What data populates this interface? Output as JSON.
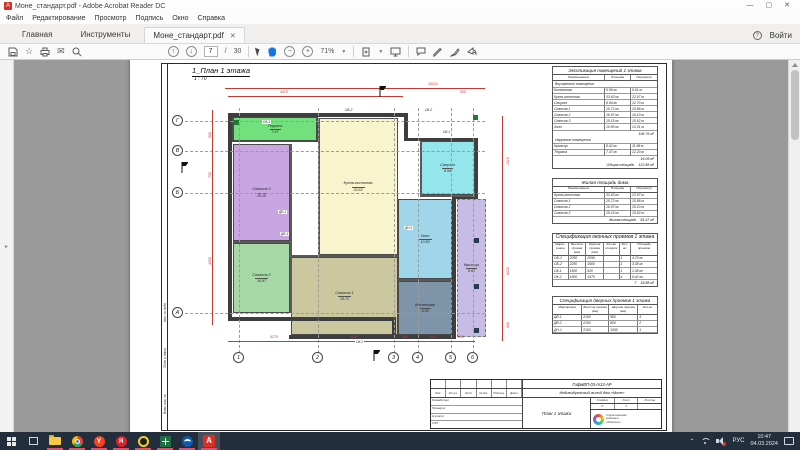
{
  "window": {
    "title": "Моне_стандарт.pdf - Adobe Acrobat Reader DC",
    "controls": {
      "minimize": "—",
      "maximize": "▢",
      "close": "✕"
    }
  },
  "menu": {
    "items": [
      "Файл",
      "Редактирование",
      "Просмотр",
      "Подпись",
      "Окно",
      "Справка"
    ]
  },
  "tabs": {
    "home": "Главная",
    "tools": "Инструменты",
    "document": "Моне_стандарт.pdf",
    "close": "✕",
    "help": "?",
    "sign_in": "Войти"
  },
  "toolbar": {
    "page_current": "7",
    "page_divider": "/",
    "page_total": "30",
    "zoom_level": "71%"
  },
  "colors": {
    "dimension_red": "#c23a32",
    "underline_pink": "#d9536f",
    "acrobat_red": "#d93025"
  },
  "drawing": {
    "title": "1_План 1 этажа",
    "scale": "1 : 70",
    "axes_letters": [
      "Г",
      "В",
      "Б",
      "А"
    ],
    "axes_numbers": [
      "1",
      "2",
      "3",
      "4",
      "5",
      "6"
    ],
    "rooms": [
      {
        "name": "Терраса",
        "area": "7.47",
        "color": "#72e07c"
      },
      {
        "name": "Кухня-гостиная",
        "area": "33.63",
        "color": "#f8f4cd"
      },
      {
        "name": "Спальня 3",
        "area": "15.15",
        "color": "#c9a6e2"
      },
      {
        "name": "Спальня 2",
        "area": "16.97",
        "color": "#a6d9a6"
      },
      {
        "name": "Спальня 1",
        "area": "15.72",
        "color": "#cbc8a0"
      },
      {
        "name": "Санузел",
        "area": "8.94",
        "color": "#93e7ec"
      },
      {
        "name": "Холл",
        "area": "10.80",
        "color": "#9fd6e9"
      },
      {
        "name": "Котельная",
        "area": "5.55",
        "color": "#7e95a9"
      },
      {
        "name": "Крыльцо",
        "area": "8.62",
        "color": "#c6bce6"
      }
    ],
    "openings": {
      "ob1": "ОБ-1",
      "ob2": "ОБ-2",
      "ok1": "ОК-1",
      "ok2": "ОК-2",
      "dv1": "ДВ-1",
      "dn1": "ДН-1"
    },
    "dims": {
      "top_overall": "16210",
      "top_left": "4470",
      "top_right": "900",
      "bottom_1": "4270",
      "bottom_2": "4250",
      "bottom_3": "800",
      "bottom_4": "1600",
      "bottom_5": "800",
      "left_1": "500",
      "left_2": "750",
      "left_3": "4650",
      "right_1": "1810",
      "right_2": "6020",
      "right_3": "880"
    }
  },
  "tables": {
    "explication": {
      "title": "Экспликация помещений 1 этажа",
      "cols": [
        "Наименование",
        "Площадь",
        "Периметр"
      ],
      "section1": "Внутренние помещения",
      "rows1": [
        [
          "Котельная",
          "5.55 м²",
          "9.61 м"
        ],
        [
          "Кухня-гостиная",
          "33.63 м²",
          "23.97 м"
        ],
        [
          "Санузел",
          "8.94 м²",
          "12.70 м"
        ],
        [
          "Спальня 1",
          "15.72 м²",
          "15.86 м"
        ],
        [
          "Спальня 2",
          "16.97 м²",
          "16.10 м"
        ],
        [
          "Спальня 3",
          "15.15 м²",
          "15.62 м"
        ],
        [
          "Холл",
          "10.80 м²",
          "13.01 м"
        ]
      ],
      "subtotal1": "106.76 м²",
      "section2": "Наружные помещения",
      "rows2": [
        [
          "Крыльцо",
          "8.62 м²",
          "11.98 м"
        ],
        [
          "Терраса",
          "7.47 м²",
          "12.20 м"
        ]
      ],
      "subtotal2": "16.09 м²",
      "total_label": "Общая площадь",
      "total": "122.85 м²"
    },
    "living": {
      "title": "Жилая площадь дома",
      "cols": [
        "Наименование",
        "Площадь",
        "Периметр"
      ],
      "rows": [
        [
          "Кухня-гостиная",
          "33.63 м²",
          "23.97 м"
        ],
        [
          "Спальня 1",
          "15.72 м²",
          "15.86 м"
        ],
        [
          "Спальня 2",
          "16.97 м²",
          "16.10 м"
        ],
        [
          "Спальня 3",
          "15.15 м²",
          "15.62 м"
        ]
      ],
      "total_label": "Жилая площадь",
      "total": "81.47 м²"
    },
    "windows": {
      "title": "Спецификация оконных проемов 1 этажа",
      "cols": [
        "Марки- ровка",
        "Высота проема (мм)",
        "Ширина проема (мм)",
        "Кол-во створок",
        "Кол- во",
        "Площадь проемов"
      ],
      "rows": [
        [
          "ОБ-1",
          "2250",
          "2090",
          "",
          "1",
          "4.70 м²"
        ],
        [
          "ОБ-2",
          "2250",
          "1500",
          "",
          "1",
          "3.38 м²"
        ],
        [
          "ОК-1",
          "1500",
          "920",
          "",
          "1",
          "1.38 м²"
        ],
        [
          "ОК-2",
          "1500",
          "1570",
          "",
          "4",
          "9.42 м²"
        ]
      ],
      "total_count": "7",
      "total_area": "18.88 м²"
    },
    "doors": {
      "title": "Спецификация дверных проемов 1 этажа",
      "cols": [
        "Маркировка",
        "Высота проема (мм)",
        "Ширина проема (мм)",
        "Кол-во"
      ],
      "rows": [
        [
          "ДВ-1",
          "2100",
          "900",
          "3"
        ],
        [
          "ДВ-2",
          "2100",
          "800",
          "2"
        ],
        [
          "ДН-1",
          "2100",
          "1050",
          "1"
        ]
      ]
    }
  },
  "title_block": {
    "code": "ГифмВП-03-т13-АР",
    "object": "Индивидуальный жилой дом «Моне»",
    "sheet_title": "План 1 этажа",
    "stamp_cols": [
      "Изм.",
      "Кол.уч.",
      "Лист",
      "№ док.",
      "Подпись",
      "Дата"
    ],
    "roles": [
      "Разработал",
      "Проверил",
      "Н.контр.",
      "ГИП"
    ],
    "stage_label": "Стадия",
    "sheet_label": "Лист",
    "sheets_label": "Листов",
    "stage": "Р",
    "sheet": "2",
    "sheets": "",
    "company": [
      "Строительная",
      "компания",
      "«Монолит»"
    ]
  },
  "side_labels": [
    "Инв. № подл.",
    "Подп. и дата",
    "Взам. инв. №"
  ],
  "taskbar": {
    "lang": "РУС",
    "time": "10:47",
    "date": "04.03.2024"
  }
}
